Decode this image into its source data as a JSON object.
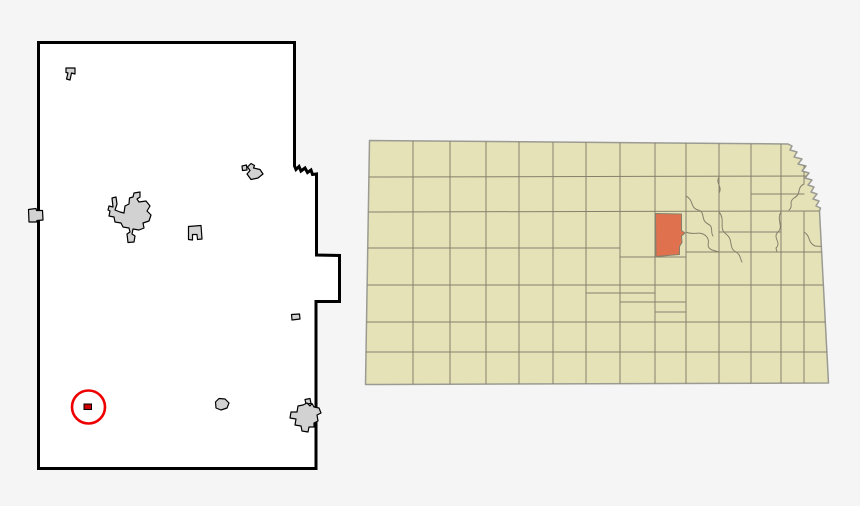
{
  "canvas": {
    "width": 860,
    "height": 506,
    "background": "#f5f5f5"
  },
  "county_map": {
    "fill": "#ffffff",
    "border": "#000000",
    "towns": {
      "fill": "#d2d2d2",
      "stroke": "#000000"
    },
    "marker": {
      "ring": "#ee0000",
      "square_fill": "#cc0000",
      "square_stroke": "#000000"
    }
  },
  "state_map": {
    "fill": "#e5e2b8",
    "border": "#9b9b93",
    "county_line": "#85806b",
    "highlight": {
      "fill": "#e0714e",
      "stroke": "#85806b"
    }
  }
}
